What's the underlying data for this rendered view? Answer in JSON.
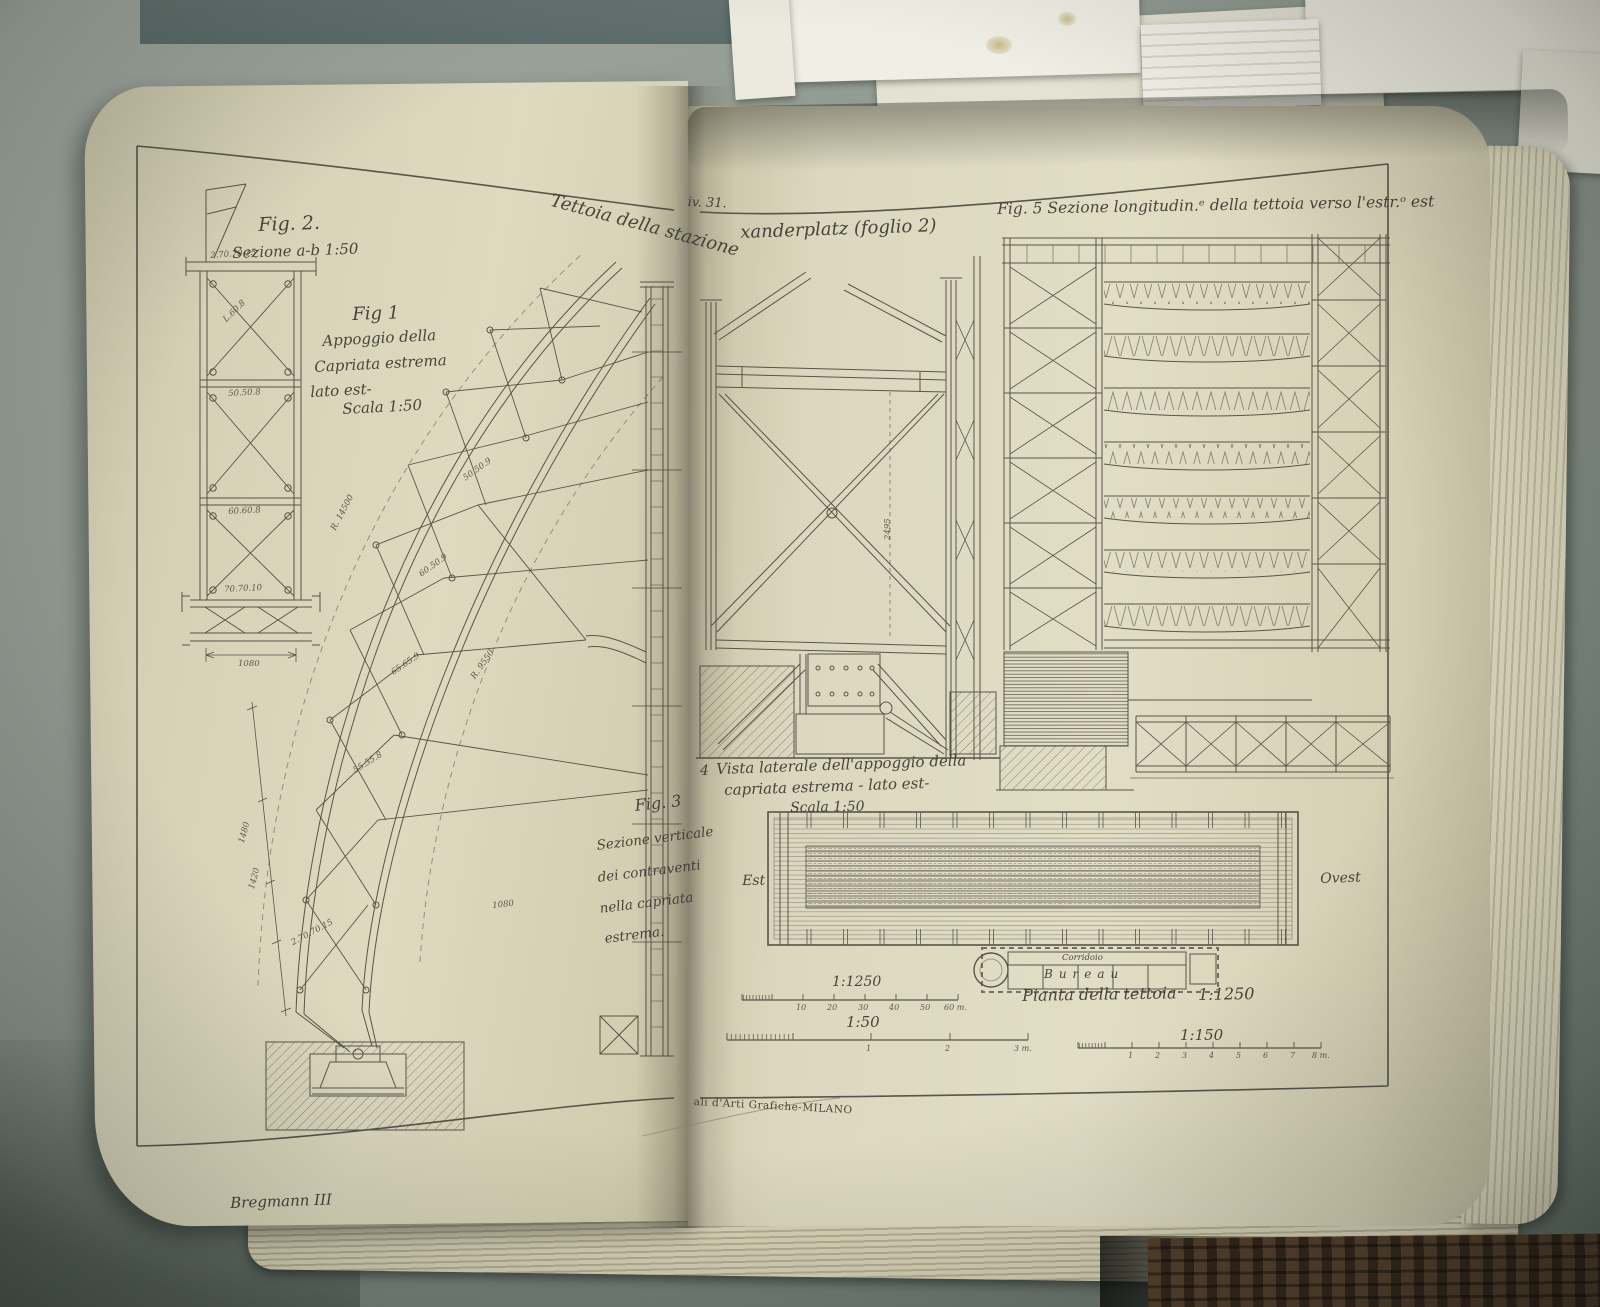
{
  "photo": {
    "plate_ref": "iv. 31.",
    "title_left": "Tettoia della stazione",
    "title_right": "xanderplatz  (foglio 2)",
    "printer_credit": "ali d'Arti Grafiche-MILANO",
    "signature": "Bregmann III"
  },
  "fig1": {
    "label": "Fig 1",
    "line1": "Appoggio della",
    "line2": "Capriata estrema",
    "line3": "lato est-",
    "line4": "Scala 1:50",
    "dims": [
      "R. 14500",
      "R. 9550",
      "50.50.9",
      "60.50.9",
      "65.65.9",
      "55.55.8",
      "1480",
      "1420",
      "1080",
      "2.70.70.15"
    ]
  },
  "fig2": {
    "label": "Fig. 2.",
    "caption": "Sezione a-b  1:50",
    "dims": [
      "2.70.70.15",
      "L.60.8",
      "50.50.8",
      "60.60.8",
      "70.70.10",
      "1080"
    ]
  },
  "fig3": {
    "label": "Fig. 3",
    "line1": "Sezione verticale",
    "line2": "dei contraventi",
    "line3": "nella capriata",
    "line4": "estrema."
  },
  "fig4": {
    "label": "4",
    "line1": "Vista laterale dell'appoggio della",
    "line2": "capriata estrema - lato est-",
    "line3": "Scala 1:50",
    "dim": "2495"
  },
  "fig5": {
    "caption": "Fig. 5 Sezione longitudin.ᵉ della tettoia verso l'estr.ᵒ est"
  },
  "plan": {
    "east": "Est",
    "west": "Ovest",
    "corridor": "Corridoio",
    "office": "Bureau",
    "caption": "Pianta della tettoia",
    "scale": "1:1250"
  },
  "scalebars": {
    "b1250": {
      "title": "1:1250",
      "ticks": [
        "10",
        "20",
        "30",
        "40",
        "50",
        "60 m."
      ]
    },
    "b50": {
      "title": "1:50",
      "ticks": [
        "1",
        "2",
        "3 m."
      ]
    },
    "b150": {
      "title": "1:150",
      "ticks": [
        "1",
        "2",
        "3",
        "4",
        "5",
        "6",
        "7",
        "8 m."
      ]
    }
  },
  "colors": {
    "page": "#ddd8c0",
    "ink": "#46433a",
    "desk": "#8d968e",
    "wall": "#5d6d6c",
    "paper": "#eceade",
    "basket": "#46332a"
  }
}
